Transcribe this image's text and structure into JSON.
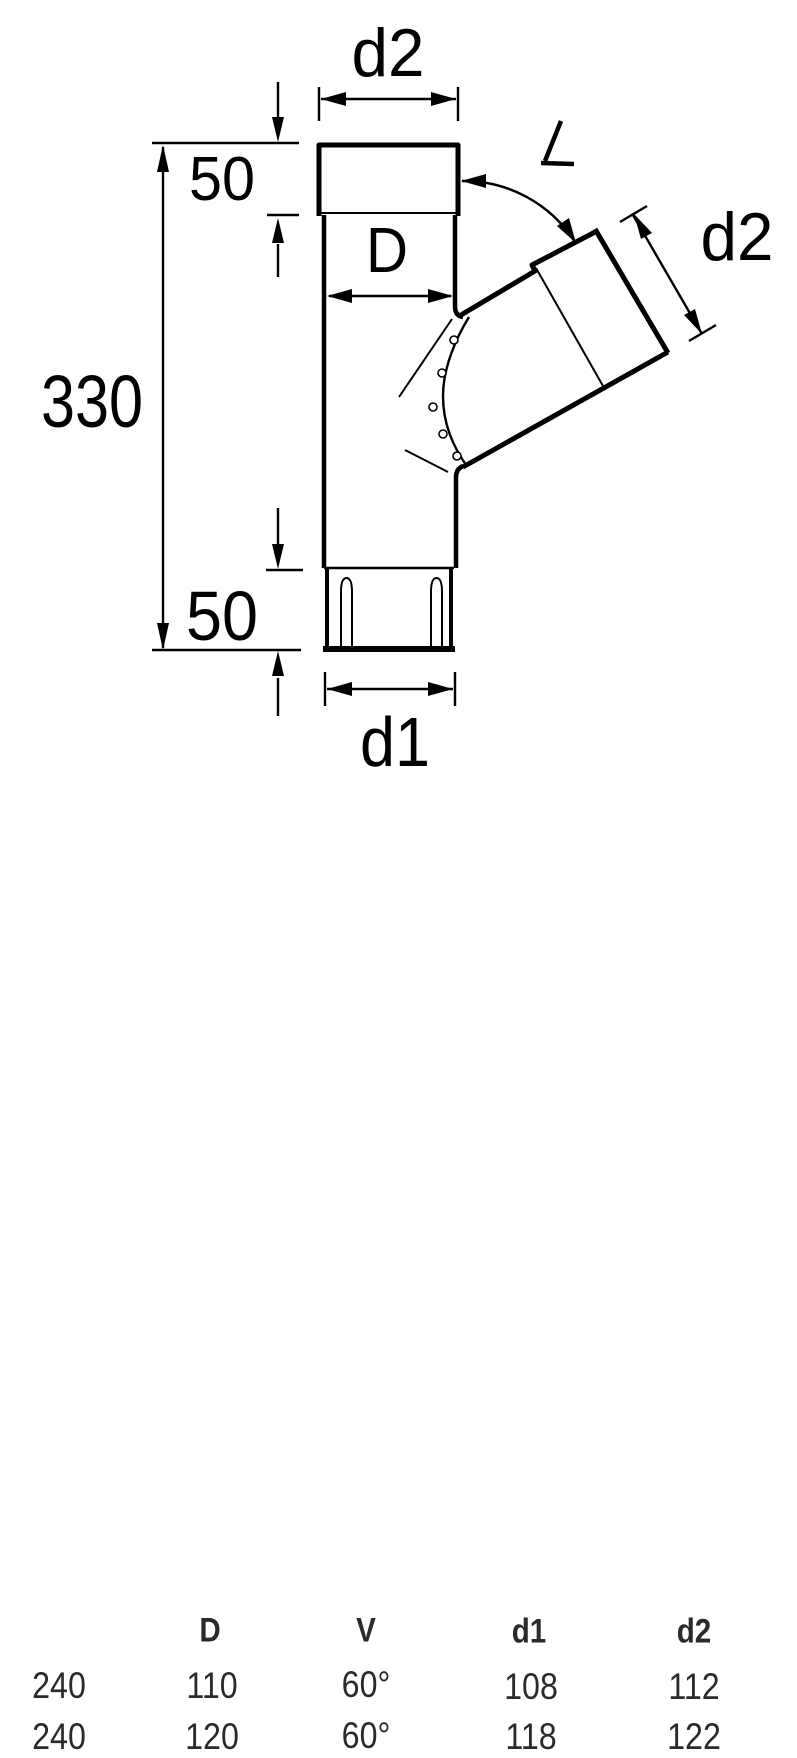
{
  "drawing": {
    "labels": {
      "top_diameter": "d2",
      "top_socket_depth": "50",
      "body_diameter": "D",
      "overall_length": "330",
      "bottom_socket_depth": "50",
      "bottom_diameter": "d1",
      "branch_diameter": "d2"
    },
    "angle_symbol": "∠"
  },
  "table": {
    "headers": [
      "",
      "D",
      "V",
      "d1",
      "d2"
    ],
    "rows": [
      [
        "240",
        "110",
        "60°",
        "108",
        "112"
      ],
      [
        "240",
        "120",
        "60°",
        "118",
        "122"
      ]
    ]
  },
  "colors": {
    "line": "#000000",
    "background": "#ffffff",
    "table_text": "#2a2a2a"
  }
}
